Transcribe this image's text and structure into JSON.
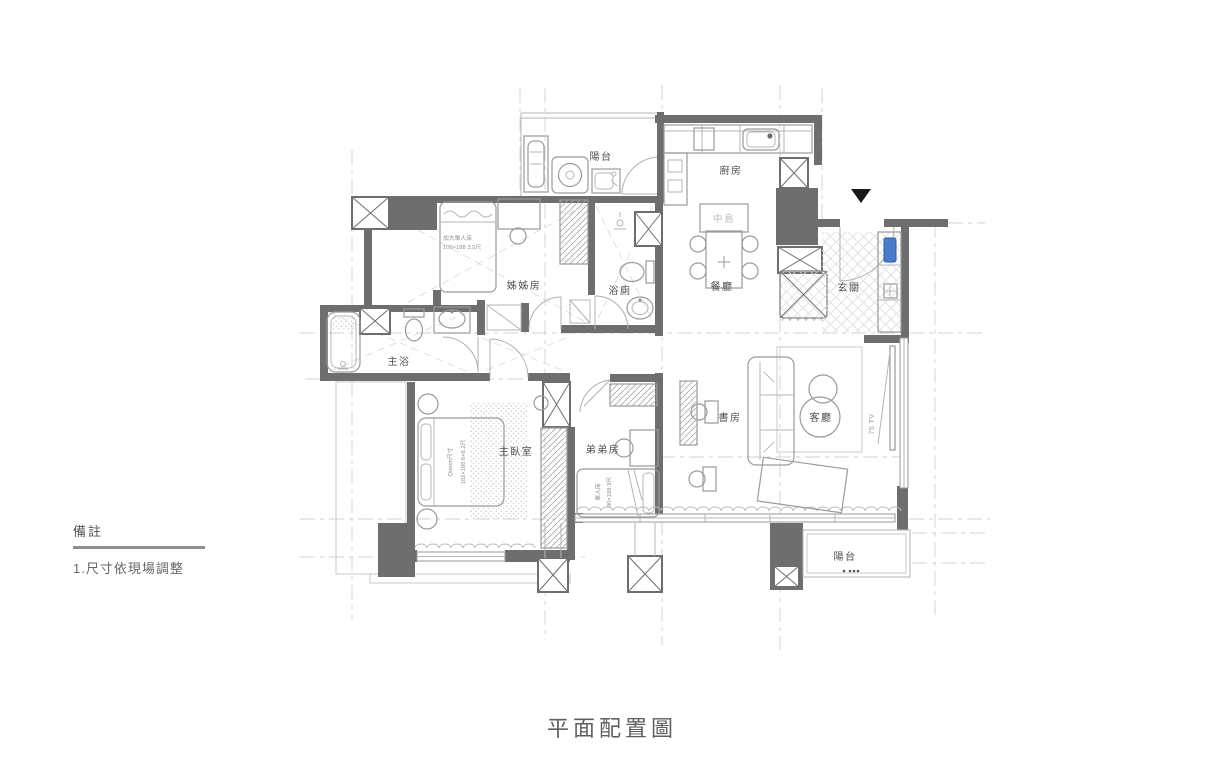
{
  "title": "平面配置圖",
  "notes": {
    "heading": "備註",
    "item1": "1.尺寸依現場調整"
  },
  "rooms": {
    "balcony_top": "陽台",
    "kitchen": "廚房",
    "island": "中島",
    "dining": "餐廳",
    "entry": "玄關",
    "sister_room": "姊姊房",
    "bathroom": "浴廁",
    "master_bath": "主浴",
    "master_bedroom": "主臥室",
    "brother_room": "弟弟房",
    "study": "書房",
    "living_room": "客廳",
    "balcony_bottom": "陽台"
  },
  "furniture": {
    "sister_bed_name": "加大單人床",
    "sister_bed_size": "106×188 3.5尺",
    "master_bed_name": "Queen尺寸",
    "master_bed_size": "182×188 6×6.2尺",
    "brother_bed_name": "單人床",
    "brother_bed_size": "90×188 3尺",
    "tv": "75 TV"
  },
  "colors": {
    "wall": "#6e6e6e",
    "furniture_line": "#9a9a9a",
    "label_text": "#4f4f4f",
    "accent_blue": "#4a7bc8",
    "guide_line": "#d2d2d2"
  }
}
